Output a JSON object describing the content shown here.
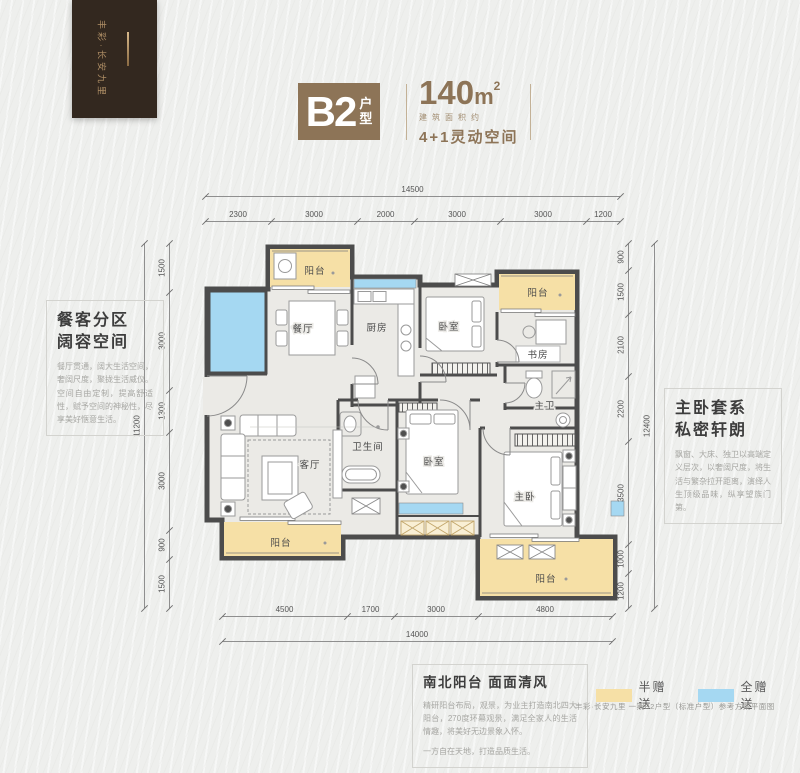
{
  "brand": {
    "logo_text": "丰彩·长安九里"
  },
  "title": {
    "code": "B2",
    "code_suffix": "户型",
    "area_value": "140",
    "area_unit": "m",
    "area_sup": "2",
    "area_caption": "建筑面积约",
    "tagline": "4+1灵动空间",
    "accent_color": "#8d7457"
  },
  "plan": {
    "labels": {
      "balcony_tl": "阳台",
      "dining": "餐厅",
      "kitchen": "厨房",
      "bedroom_top": "卧室",
      "balcony_tr": "阳台",
      "study": "书房",
      "master_bath": "主卫",
      "bathroom": "卫生间",
      "bedroom_mid": "卧室",
      "living": "客厅",
      "master_bedroom": "主卧",
      "balcony_bl": "阳台",
      "balcony_br": "阳台"
    },
    "colors": {
      "wall": "#4c4c4c",
      "floor": "#ebeae6",
      "gift_half": "#f6e0a6",
      "gift_full": "#a5d8f2"
    }
  },
  "dims": {
    "top_total": "14500",
    "top": [
      "2300",
      "3000",
      "2000",
      "3000",
      "3000",
      "1200"
    ],
    "bottom": [
      "4500",
      "1700",
      "3000",
      "4800"
    ],
    "bottom_total": "14000",
    "left_total": "11200",
    "left": [
      "1500",
      "3000",
      "1300",
      "3000",
      "900",
      "1500"
    ],
    "right": [
      "900",
      "1500",
      "2100",
      "2200",
      "3500",
      "1000",
      "1200"
    ],
    "right_total": "12400"
  },
  "callout_left": {
    "title_line1": "餐客分区",
    "title_line2": "阔容空间",
    "body": "餐厅贯通，阔大生活空间，奢阔尺度，聚拢生活威仪。空间自由定制，提高舒适性，赋予空间的神秘性，尽享美好惬意生活。"
  },
  "callout_right": {
    "title_line1": "主卧套系",
    "title_line2": "私密轩朗",
    "body": "飘窗、大床、独卫以高端定义层次，以奢阔尺度，将生活与繁杂拉开距离，演绎人生顶级品味，纵享望族门第。"
  },
  "callout_bottom": {
    "title": "南北阳台  面面清风",
    "body1": "精研阳台布局，观景，为业主打造南北四大阳台，270度环幕观景，满足全家人的生活情趣，将美好无边景象入怀。",
    "body2": "一方自在天地，打造品质生活。"
  },
  "legend": {
    "half_label": "半赠送",
    "full_label": "全赠送",
    "half_color": "#f6e0a6",
    "full_color": "#a5d8f2"
  },
  "footnote": "丰彩·长安九里 一期B2户型（标准户型）参考方案平面图"
}
